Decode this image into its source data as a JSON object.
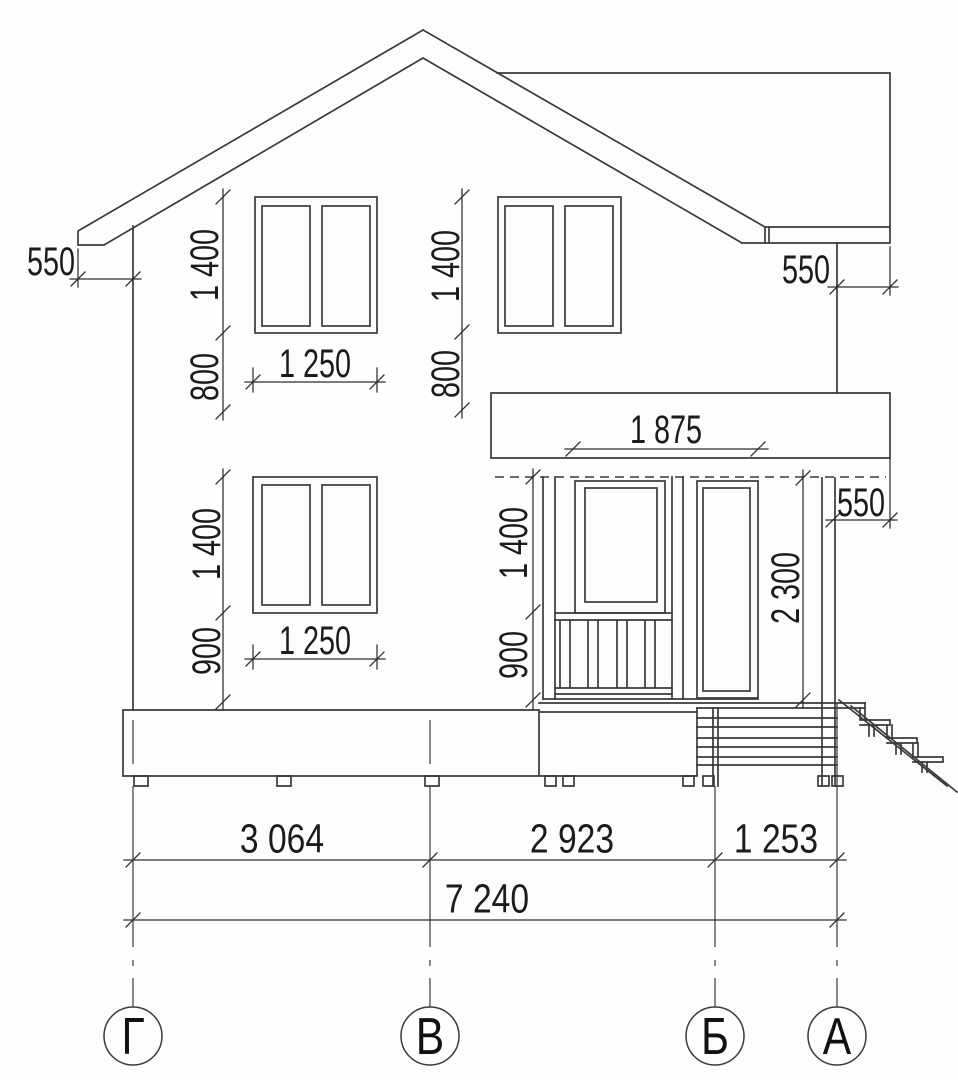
{
  "axes": {
    "g": "Г",
    "v": "В",
    "b": "Б",
    "a": "А"
  },
  "dims": {
    "roof_overhang_left": "550",
    "roof_overhang_right": "550",
    "porch_roof_overhang": "550",
    "upper_left_window_height": "1 400",
    "upper_left_window_sill": "800",
    "upper_left_window_width": "1 250",
    "upper_right_window_height": "1 400",
    "upper_right_window_sill": "800",
    "lower_window_height": "1 400",
    "lower_window_sill": "900",
    "lower_window_width": "1 250",
    "porch_glazing_width": "1 875",
    "porch_window_height": "1 400",
    "porch_rail_height": "900",
    "porch_clear_height": "2 300",
    "span_g_v": "3 064",
    "span_v_b": "2 923",
    "span_b_a": "1 253",
    "span_total": "7 240"
  }
}
